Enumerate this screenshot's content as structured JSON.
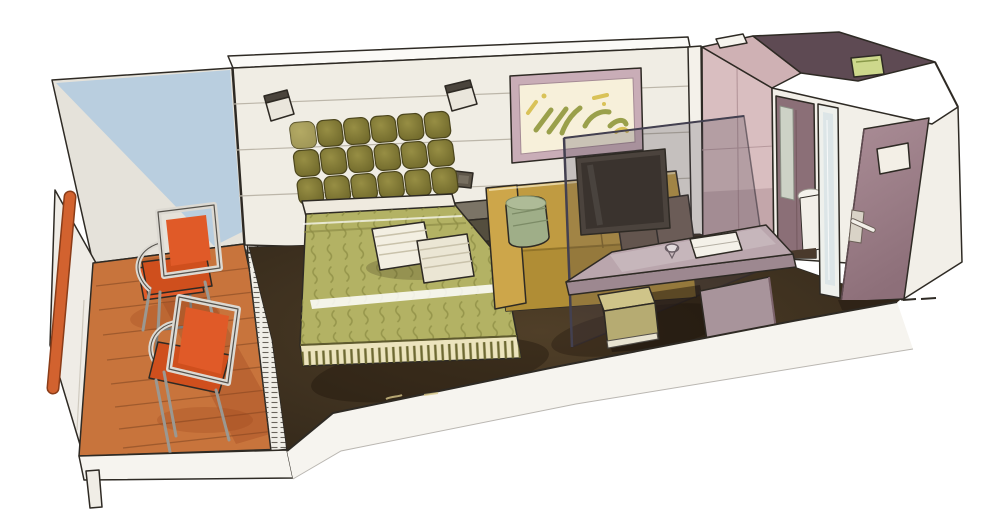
{
  "meta": {
    "subject": "Hand-drawn watercolor cutaway illustration of a ship cabin with balcony, bedroom and bathroom",
    "style": "ink outline with watercolor fills",
    "background": "#ffffff"
  },
  "palette": {
    "ink": "#2e2a24",
    "wall_cream": "#f0ede4",
    "ceiling_white": "#fbfaf7",
    "balcony_blue": "#b9cedf",
    "balcony_grey": "#e5e2da",
    "deck_wood": "#c8743c",
    "deck_plank_line": "#96542a",
    "rail_orange": "#d2622f",
    "chair_orange": "#e05a28",
    "chair_orange_dark": "#cf4f1d",
    "metal_frame": "#dcd9d2",
    "track_white": "#f0eee7",
    "divider_white": "#f3f1ea",
    "curtain_gold": "#d8bd77",
    "headboard_olive": "#7d7530",
    "bed_green": "#b3b264",
    "bed_pattern_olive": "#8a8a42",
    "skirt_cream": "#ece4bd",
    "pillow_cream": "#f3efe2",
    "carpet_brown": "#43351f",
    "nightstand_grey": "#7b7466",
    "sofa_mustard": "#c09b41",
    "sofa_pillow_sage": "#9fae88",
    "cushion_brown": "#6d5c4e",
    "art_frame_mauve": "#c9adb7",
    "art_paper": "#f7f0da",
    "art_olive": "#9aa04b",
    "art_yellow": "#d9c258",
    "glass_tint": "rgba(72,65,80,0.26)",
    "tv_dark": "#4b433d",
    "desk_mauve": "#baa6ad",
    "desk_edge_mauve": "#9d8890",
    "pedestal_mauve": "#a8949b",
    "stool_olive": "#cfc489",
    "bath_pink": "#d9bec0",
    "bath_roof_pink": "#cfb1b4",
    "void_plum": "#5e4a53",
    "light_fixture_green": "#cdd88c",
    "vestibule_white": "#f2efe8",
    "bath_interior_mauve": "#8b6f77",
    "door_mauve": "#a48791",
    "shower_glass_blue": "#d5e2e6",
    "toilet_white": "#f2efe8",
    "band_white": "#f6f4ef"
  },
  "scene": {
    "balcony": [
      "orange handrail",
      "two-tone side wall",
      "wood plank deck",
      "cafe table with tray and cups",
      "two orange chairs",
      "sliding-door track"
    ],
    "bedroom": [
      "tufted olive headboard",
      "two wall lamps",
      "green patterned bed with pleated skirt",
      "two striped pillows",
      "nightstand",
      "light switch",
      "abstract wall art",
      "mustard sofa with sage bolster",
      "smoked-glass TV panel",
      "angled desk with book and glass",
      "stool",
      "dark carpet"
    ],
    "bathroom": [
      "pink cabin module",
      "open ceiling void with light fixture",
      "doorway with mirror and toilet",
      "shower glass",
      "open entry door with window and handle",
      "corridor wall"
    ]
  }
}
